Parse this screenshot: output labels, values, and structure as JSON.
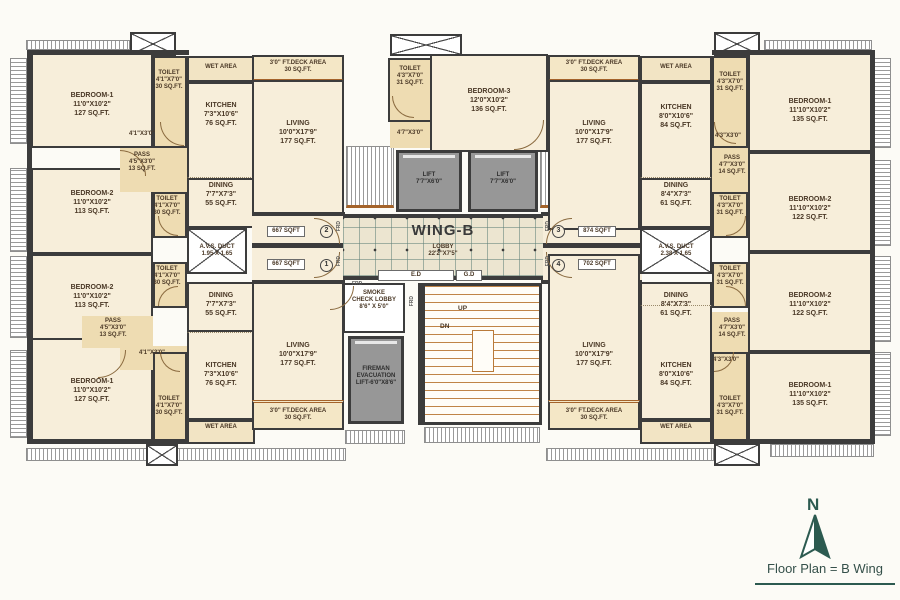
{
  "meta": {
    "north": "N",
    "caption": "Floor Plan = B Wing"
  },
  "lobby": {
    "wing": "WING-B",
    "name": "LOBBY",
    "dim": "22'2\"X7'5\"",
    "ed": "E.D",
    "gd": "G.D"
  },
  "areas": {
    "a1": "667 SQFT",
    "a2": "667 SQFT",
    "a3": "874 SQFT",
    "a4": "702 SQFT"
  },
  "flats": {
    "f1": "1",
    "f2": "2",
    "f3": "3",
    "f4": "4"
  },
  "rooms": {
    "bed1L": {
      "name": "BEDROOM-1",
      "dim": "11'0\"X10'2\"",
      "area": "127 SQ.FT."
    },
    "bed2L": {
      "name": "BEDROOM-2",
      "dim": "11'0\"X10'2\"",
      "area": "113 SQ.FT."
    },
    "bed3": {
      "name": "BEDROOM-3",
      "dim": "12'0\"X10'2\"",
      "area": "136 SQ.FT."
    },
    "bed1R": {
      "name": "BEDROOM-1",
      "dim": "11'10\"X10'2\"",
      "area": "135 SQ.FT."
    },
    "bed2R": {
      "name": "BEDROOM-2",
      "dim": "11'10\"X10'2\"",
      "area": "122 SQ.FT."
    },
    "toiletL": {
      "name": "TOILET",
      "dim": "4'1\"X7'0\"",
      "area": "30 SQ.FT."
    },
    "toiletR": {
      "name": "TOILET",
      "dim": "4'3\"X7'0\"",
      "area": "31 SQ.FT."
    },
    "kitchenL": {
      "name": "KITCHEN",
      "dim": "7'3\"X10'6\"",
      "area": "76 SQ.FT."
    },
    "kitchenR": {
      "name": "KITCHEN",
      "dim": "8'0\"X10'6\"",
      "area": "84 SQ.FT."
    },
    "diningL": {
      "name": "DINING",
      "dim": "7'7\"X7'3\"",
      "area": "55 SQ.FT."
    },
    "diningR": {
      "name": "DINING",
      "dim": "8'4\"X7'3\"",
      "area": "61 SQ.FT."
    },
    "living": {
      "name": "LIVING",
      "dim": "10'0\"X17'9\"",
      "area": "177 SQ.FT."
    },
    "passL": {
      "name": "PASS",
      "dim": "4'5\"X3'0\"",
      "area": "13 SQ.FT."
    },
    "passR": {
      "name": "PASS",
      "dim": "4'7\"X3'0\"",
      "area": "14 SQ.FT."
    },
    "deck": {
      "name": "3'0\" FT.DECK AREA",
      "area": "30 SQ.FT."
    },
    "wet": {
      "name": "WET AREA"
    },
    "avsL": {
      "name": "A.V.S. DUCT",
      "dim": "1.95 X 1.65"
    },
    "avsR": {
      "name": "A.V.S. DUCT",
      "dim": "2.38 X 1.65"
    },
    "lift": {
      "name": "LIFT",
      "dim": "7'7\"X6'0\""
    },
    "fireman": {
      "l1": "FIREMAN",
      "l2": "EVACUATION",
      "l3": "LIFT-6'0\"X8'6\""
    },
    "smoke": {
      "l1": "SMOKE",
      "l2": "CHECK LOBBY",
      "l3": "8'6\" X 5'0\""
    }
  },
  "passages": {
    "p41": "4'1\"X3'0\"",
    "p43": "4'3\"X3'0\"",
    "p47": "4'7\"X3'0\""
  },
  "misc": {
    "up": "UP",
    "dn": "DN",
    "frd": "FRD"
  }
}
